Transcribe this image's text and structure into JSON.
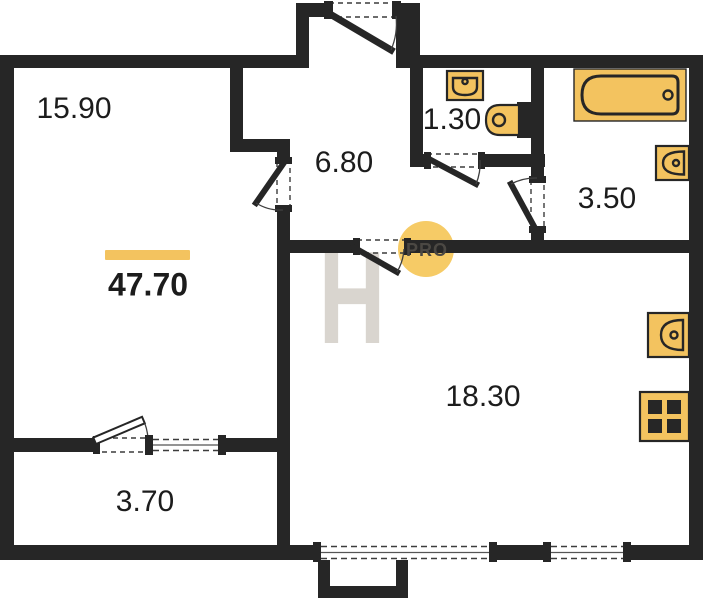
{
  "plan": {
    "total_area": {
      "value": "47.70"
    },
    "rooms": [
      {
        "name": "living-room",
        "area": "15.90"
      },
      {
        "name": "hallway",
        "area": "6.80"
      },
      {
        "name": "wc",
        "area": "1.30"
      },
      {
        "name": "bathroom",
        "area": "3.50"
      },
      {
        "name": "kitchen-living",
        "area": "18.30"
      },
      {
        "name": "balcony",
        "area": "3.70"
      }
    ],
    "fixtures": [
      "bathtub-icon",
      "washbasin-icon",
      "toilet-icon",
      "bathroom-sink-icon",
      "kitchen-sink-icon",
      "stove-icon"
    ],
    "watermark": {
      "letter": "H",
      "badge": "PRO"
    }
  },
  "colors": {
    "accent": "#F3C35F",
    "wall": "#262626",
    "watermark": "#D9D5CF",
    "badge": "#F6C85E",
    "badge_text": "#4B4843",
    "label": "#1C1C1C"
  }
}
